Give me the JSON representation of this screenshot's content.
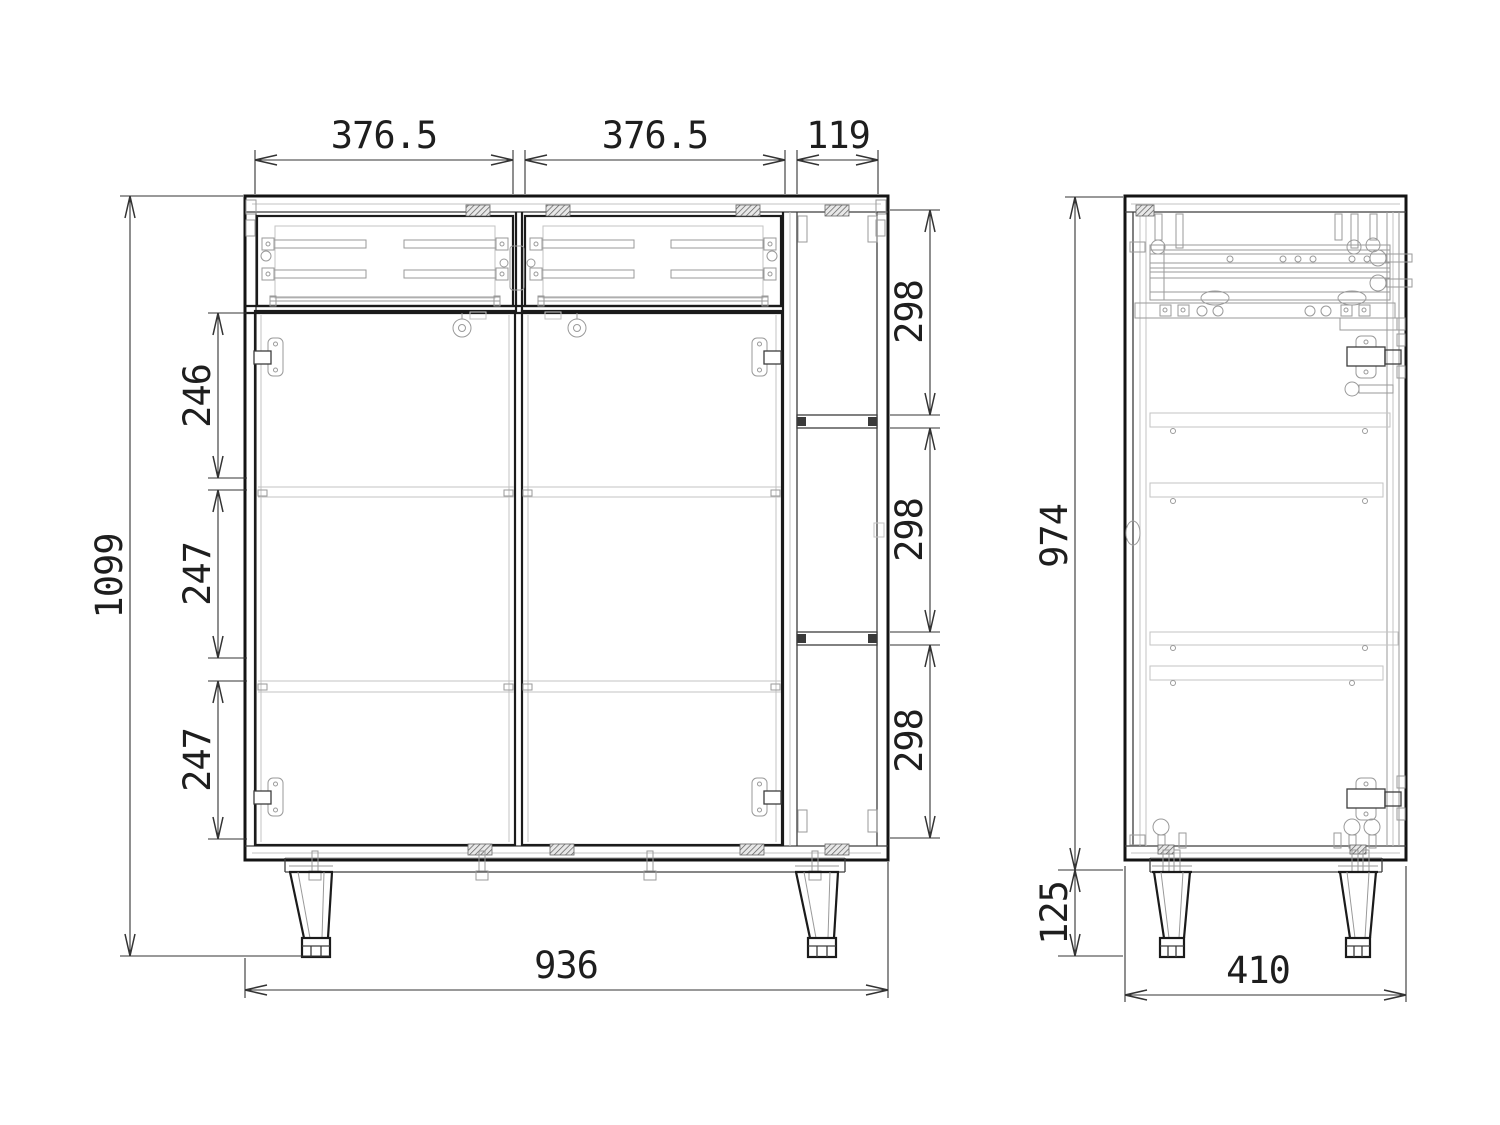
{
  "drawing": {
    "front_view": {
      "dim_drawer_left_width": "376.5",
      "dim_drawer_right_width": "376.5",
      "dim_open_column_width": "119",
      "dim_overall_height": "1099",
      "dim_shelf_gap_top": "246",
      "dim_shelf_gap_middle": "247",
      "dim_shelf_gap_bottom": "247",
      "dim_niche_top": "298",
      "dim_niche_middle": "298",
      "dim_niche_bottom": "298",
      "dim_overall_width": "936"
    },
    "side_view": {
      "dim_carcass_height": "974",
      "dim_leg_height": "125",
      "dim_depth": "410"
    }
  }
}
